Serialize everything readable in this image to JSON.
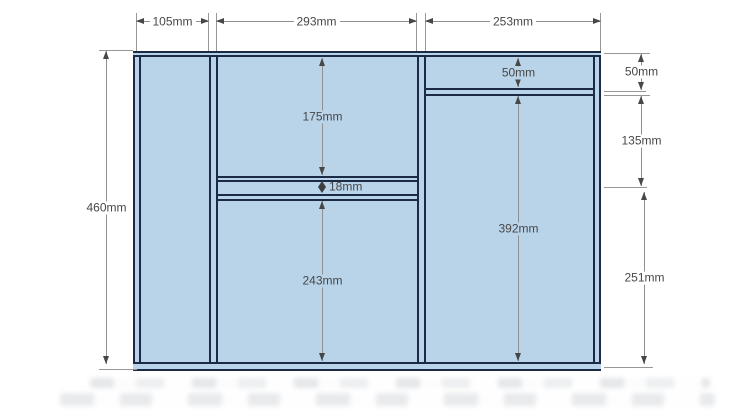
{
  "diagram": {
    "type": "panel_cut_dimension_drawing",
    "top_dimensions": [
      {
        "label": "105mm"
      },
      {
        "label": "293mm"
      },
      {
        "label": "253mm"
      }
    ],
    "left_dimensions": [
      {
        "label": "460mm"
      }
    ],
    "right_dimensions": [
      {
        "label": "50mm"
      },
      {
        "label": "135mm"
      },
      {
        "label": "251mm"
      }
    ],
    "interior_dimensions": [
      {
        "label": "175mm",
        "region": "middle-top-section"
      },
      {
        "label": "18mm",
        "region": "middle-shelf-gap"
      },
      {
        "label": "243mm",
        "region": "middle-bottom-section"
      },
      {
        "label": "50mm",
        "region": "right-top-section"
      },
      {
        "label": "392mm",
        "region": "right-main-section"
      }
    ],
    "colors": {
      "panel_fill": "#b9d3e9",
      "panel_outline": "#1c2b45",
      "dimension_line": "#8f8f8f",
      "dimension_text": "#474747",
      "background": "#ffffff"
    }
  }
}
